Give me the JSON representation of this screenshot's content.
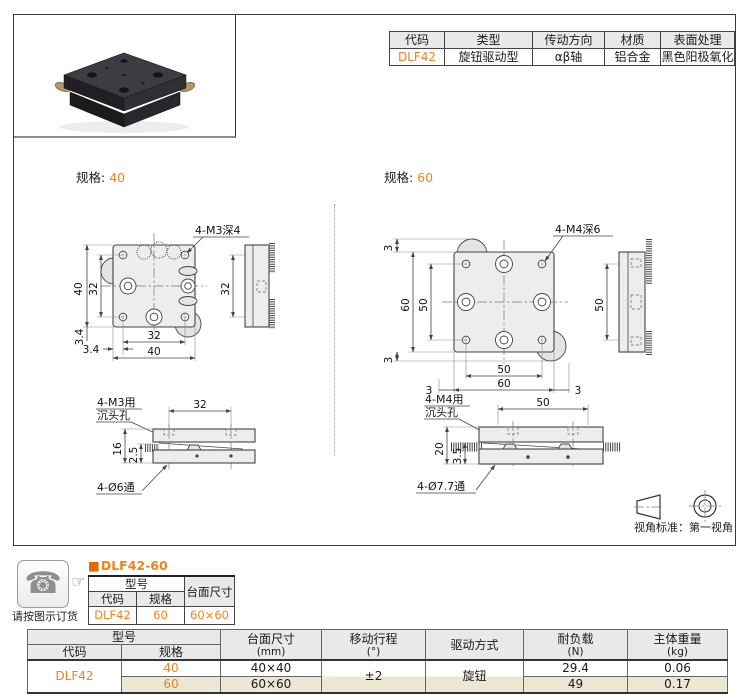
{
  "colors": {
    "accent": "#F0821E",
    "header_bg": "#E9E9E9",
    "row_beige": "#EAE7D3"
  },
  "info_table": {
    "headers": [
      "代码",
      "类型",
      "传动方向",
      "材质",
      "表面处理"
    ],
    "row": [
      "DLF42",
      "旋钮驱动型",
      "αβ轴",
      "铝合金",
      "黑色阳极氧化"
    ]
  },
  "spec40": {
    "label": "规格:",
    "value": "40",
    "top": {
      "callout": "4-M3深4",
      "dim_v_outer": "40",
      "dim_v_inner": "32",
      "dim_v_offset": "3.4",
      "dim_h_offset": "3.4",
      "dim_h_inner": "32",
      "dim_h_outer": "40"
    },
    "side": {
      "dim": "32"
    },
    "front": {
      "callout1": "4-M3用",
      "callout2": "沉头孔",
      "dim_top": "32",
      "dim_h": "16",
      "dim_h2": "2.5",
      "callout_bottom": "4-Ø6通"
    }
  },
  "spec60": {
    "label": "规格:",
    "value": "60",
    "top": {
      "callout": "4-M4深6",
      "dim_top_offset": "3",
      "dim_v_outer": "60",
      "dim_v_inner": "50",
      "dim_v_offset_bottom": "3",
      "dim_h_left": "3",
      "dim_h_inner": "50",
      "dim_h_outer": "60",
      "dim_h_right": "3"
    },
    "side": {
      "dim": "50"
    },
    "front": {
      "callout1": "4-M4用",
      "callout2": "沉头孔",
      "dim_top": "50",
      "dim_h": "20",
      "dim_h2": "3.5",
      "callout_bottom": "4-Ø7.7通"
    }
  },
  "projection": {
    "caption": "视角标准：第一视角"
  },
  "order": {
    "note": "请按图示订货",
    "bullet": "■",
    "title": "DLF42-60",
    "table": {
      "header_model": "型号",
      "header_code": "代码",
      "header_spec": "规格",
      "header_size": "台面尺寸",
      "row": {
        "code": "DLF42",
        "spec": "60",
        "size": "60×60"
      }
    }
  },
  "spec_table": {
    "header": {
      "model": "型号",
      "code": "代码",
      "spec": "规格",
      "size": [
        "台面尺寸",
        "(mm)"
      ],
      "travel": [
        "移动行程",
        "(°)"
      ],
      "drive": "驱动方式",
      "load": [
        "耐负载",
        "(N)"
      ],
      "weight": [
        "主体重量",
        "(kg)"
      ]
    },
    "code": "DLF42",
    "travel": "±2",
    "drive": "旋钮",
    "rows": [
      {
        "spec": "40",
        "size": "40×40",
        "load": "29.4",
        "weight": "0.06"
      },
      {
        "spec": "60",
        "size": "60×60",
        "load": "49",
        "weight": "0.17"
      }
    ]
  }
}
